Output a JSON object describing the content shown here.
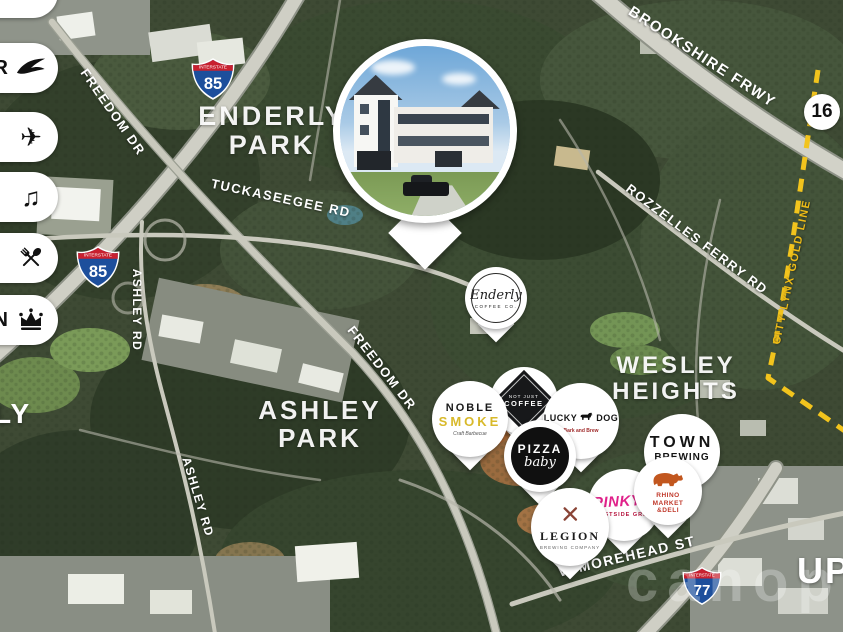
{
  "amenity_pills": [
    {
      "letter": "",
      "icon": "bird-icon"
    },
    {
      "letter": "R",
      "icon": "bird-icon"
    },
    {
      "letter": "",
      "icon": "airplane-icon"
    },
    {
      "letter": "",
      "icon": "music-note-icon"
    },
    {
      "letter": "",
      "icon": "dining-icon"
    },
    {
      "letter": "N",
      "icon": "crown-icon"
    }
  ],
  "highways": {
    "interstate_label": "INTERSTATE",
    "i85": "85",
    "i77": "77",
    "nc16": "16"
  },
  "roads": {
    "freedom": "FREEDOM DR",
    "tuckaseegee": "TUCKASEEGEE RD",
    "rozzelles": "ROZZELLES FERRY RD",
    "brookshire": "BROOKSHIRE FRWY",
    "ashley": "ASHLEY RD",
    "morehead": "W MOREHEAD ST",
    "gold_line": "CITY LYNX GOLD LINE"
  },
  "neighborhoods": {
    "enderly": {
      "l1": "ENDERLY",
      "l2": "PARK"
    },
    "ashley": {
      "l1": "ASHLEY",
      "l2": "PARK"
    },
    "wesley": {
      "l1": "WESLEY",
      "l2": "HEIGHTS"
    },
    "partial_left": "LY",
    "partial_right": "UP"
  },
  "pins": {
    "enderly_coffee": {
      "name": "Enderly",
      "sub": "COFFEE CO."
    },
    "noble_smoke": {
      "line1": "NOBLE",
      "line2": "SMOKE",
      "tagline": "Craft Barbecue"
    },
    "not_just_coffee": {
      "top": "NOT JUST",
      "main": "COFFEE",
      "icon": "diamond-logo"
    },
    "lucky_dog": {
      "name1": "LUCKY",
      "name2": "DOG",
      "tagline": "Bark and Brew",
      "icon": "dog-icon"
    },
    "pizza_baby": {
      "line1": "PIZZA",
      "line2": "baby"
    },
    "town_brewing": {
      "line1": "TOWN",
      "line2": "BREWING",
      "line3": "CO"
    },
    "pinkys": {
      "name": "PINKY'S",
      "sub": "WESTSIDE GRILL"
    },
    "rhino_market": {
      "line1": "RHINO",
      "line2": "MARKET",
      "line3": "&DELI",
      "icon": "rhino-icon"
    },
    "legion": {
      "name": "LEGION",
      "sub": "BREWING COMPANY",
      "icon": "crossed-paddles-icon"
    }
  },
  "watermark": "canopy",
  "colors": {
    "gold_line": "#f2c41d",
    "shield_blue": "#1d4f9c",
    "shield_red": "#c8202f",
    "noble_yellow": "#d8b92a",
    "pinky_magenta": "#e0218a",
    "rhino_orange": "#c2571f"
  }
}
